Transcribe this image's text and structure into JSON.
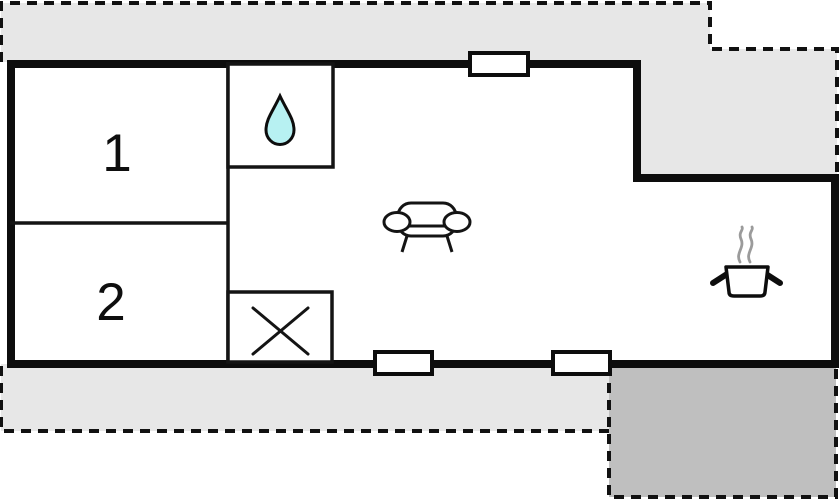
{
  "floor_plan": {
    "rooms": [
      {
        "name": "bedroom-1",
        "label": "1"
      },
      {
        "name": "bedroom-2",
        "label": "2"
      },
      {
        "name": "bathroom",
        "icon": "water-drop-icon"
      },
      {
        "name": "utility-room",
        "icon": "cross-mark-icon"
      },
      {
        "name": "living-room",
        "icon": "sofa-icon"
      },
      {
        "name": "kitchen",
        "icon": "cooking-pot-icon"
      }
    ],
    "windows": [
      "top-wall-window",
      "bottom-wall-window-left",
      "bottom-wall-window-right"
    ],
    "outdoor_areas": [
      "terrace-top",
      "terrace-bottom",
      "patio-dark"
    ],
    "colors": {
      "terrace_light": "#e7e7e7",
      "patio_dark": "#bfbfbf",
      "wall": "#0d0d0d",
      "interior": "#ffffff",
      "water_drop": "#b7f1f2",
      "steam": "#9b9b9b"
    }
  }
}
